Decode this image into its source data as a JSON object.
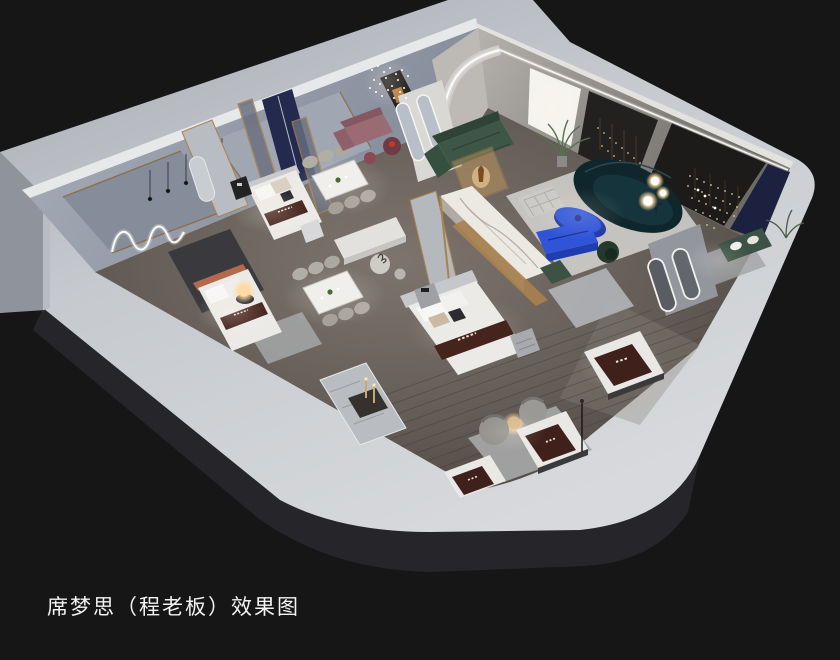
{
  "caption": {
    "text": "席梦思（程老板）效果图"
  },
  "scene": {
    "type": "3d-isometric-interior-rendering",
    "description": "Cutaway axonometric rendering of a Simmons mattress showroom on a grey slab over a black backdrop: bedrooms with display beds and branded mattress runners, two dining sets, a lounge with green modular sofa, dark teal curved sofa and cobalt blue tables, marble and navy partitions with brass frames, LED arch, arched mirrors, string-light wall art and glowing lamps.",
    "objects": [
      "concrete display slab",
      "wood plank floor",
      "back wall with wavy neon light",
      "pendant bulbs",
      "brass framed navy partitions",
      "white display beds",
      "brown branded mattress runners",
      "terracotta bed with glowing orb lamp",
      "marble partition with brass band",
      "dining table with six chairs (x2)",
      "mauve sofa set",
      "green modular sofa",
      "amber glass display case",
      "dark teal curved sofa",
      "cobalt coffee table",
      "cobalt media bench",
      "knitted ottoman",
      "palm plant",
      "sphere floor lamp",
      "sparkle chandelier",
      "backlit white panel",
      "black panel with string lights",
      "charcoal wall with cascading lights",
      "navy wall panel",
      "green bench with pillows",
      "arched floor mirrors",
      "capsule mirrors",
      "barrel lounge chairs",
      "glowing side table",
      "candlestick console on marble rug",
      "floor mattress displays",
      "area rugs"
    ]
  },
  "palette": {
    "background": "#161616",
    "slab_concrete": "#c6c9ce",
    "slab_edge": "#26262a",
    "wall_grey_blue": "#9aa0ac",
    "wood_floor": "#6b635d",
    "rug_grey": "#b7b9bc",
    "marble_white": "#ece9e3",
    "brass_gold": "#a8824f",
    "navy_panel": "#232a4e",
    "cobalt_blue": "#2f54d8",
    "sofa_green": "#3e5747",
    "sofa_dark_teal": "#0f262c",
    "mattress_runner_brown": "#46241e",
    "bedding_white": "#eceae7",
    "terracotta": "#b4694d",
    "mauve": "#9b6b74",
    "warm_glow": "#ffc983",
    "led_white": "#f5f5f0"
  }
}
